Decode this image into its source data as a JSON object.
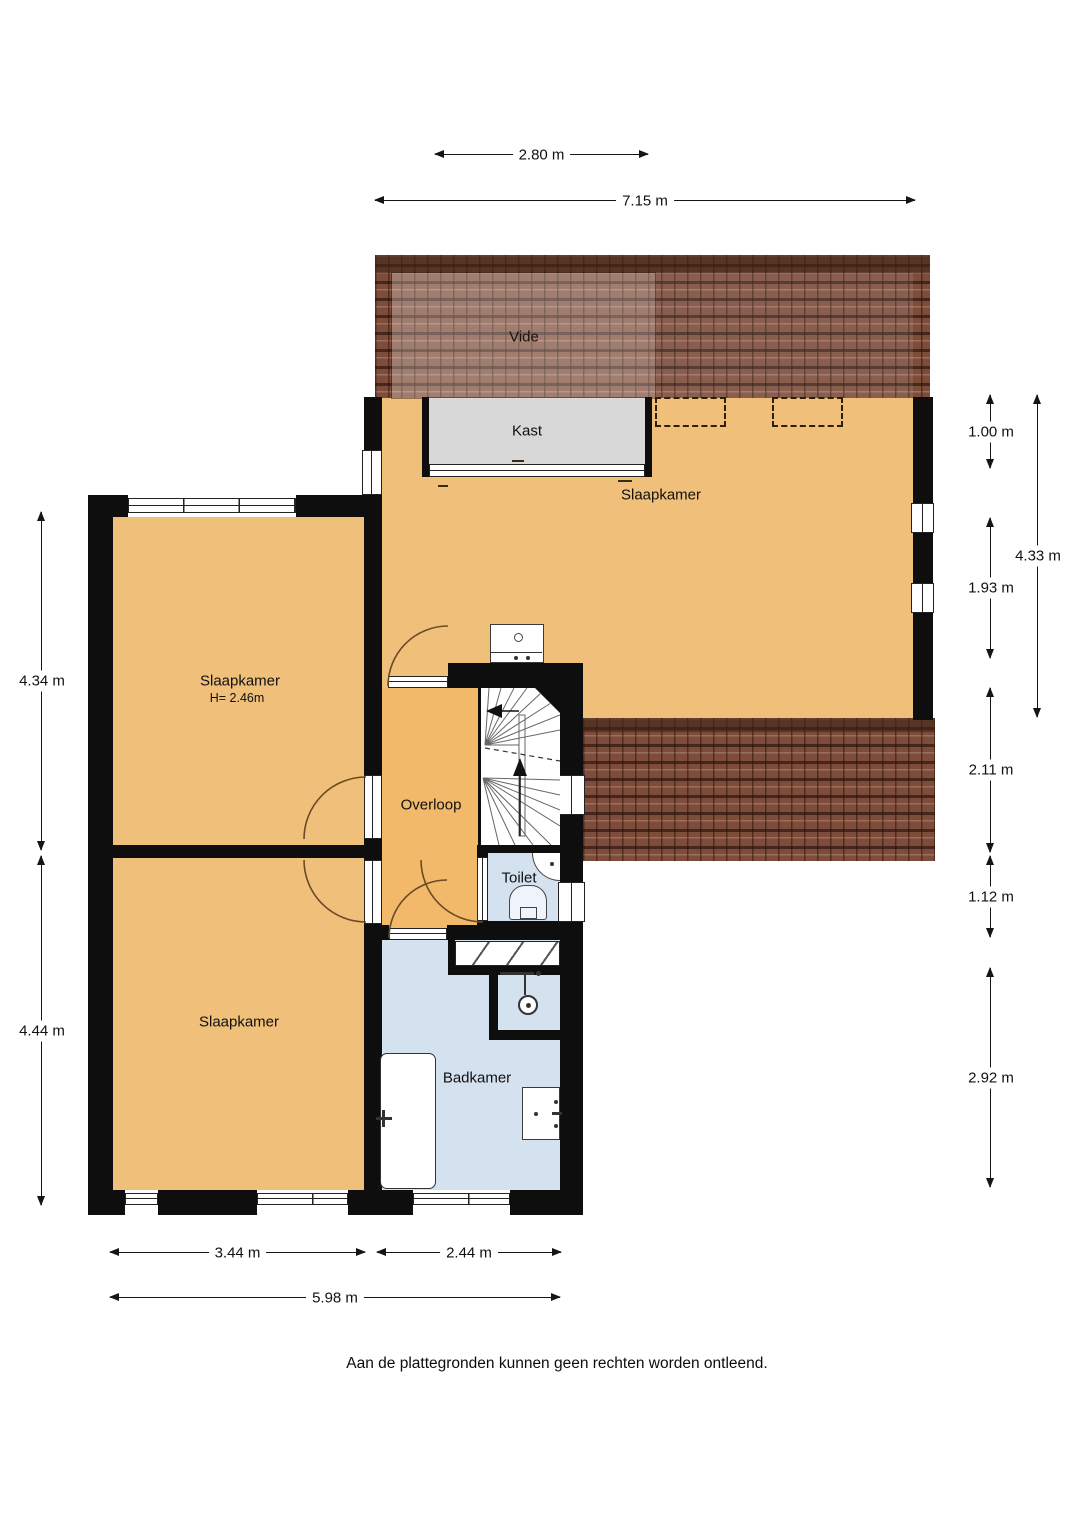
{
  "rooms": {
    "vide": {
      "label": "Vide"
    },
    "kast": {
      "label": "Kast"
    },
    "bedroom_main": {
      "label": "Slaapkamer"
    },
    "bedroom_left_top": {
      "label": "Slaapkamer",
      "ceiling_height": "H= 2.46m"
    },
    "bedroom_left_bottom": {
      "label": "Slaapkamer"
    },
    "landing": {
      "label": "Overloop"
    },
    "toilet": {
      "label": "Toilet"
    },
    "bathroom": {
      "label": "Badkamer"
    }
  },
  "dimensions": {
    "top_inner": "2.80 m",
    "top_total": "7.15 m",
    "right_top": "1.00 m",
    "right_mid": "1.93 m",
    "right_span": "4.33 m",
    "right_lower": "2.11 m",
    "right_small": "1.12 m",
    "right_bottom": "2.92 m",
    "left_top": "4.34 m",
    "left_bottom": "4.44 m",
    "bottom_left": "3.44 m",
    "bottom_right": "2.44 m",
    "bottom_total": "5.98 m"
  },
  "footer": {
    "disclaimer": "Aan de plattegronden kunnen geen rechten worden ontleend."
  },
  "fixtures": {
    "icons": [
      "washbasin-icon",
      "corner-sink-icon",
      "toilet-bowl-icon",
      "shower-head-icon",
      "bathtub-icon",
      "staircase-icon"
    ]
  },
  "colors": {
    "floor": "#f0c07a",
    "landing": "#f2b96b",
    "wet_room": "#d4e2ef",
    "closet": "#d8d8d8",
    "wall": "#0e0e0e",
    "roof_base": "#7d4c3a",
    "roof_shadow": "#3f2418",
    "door_arc": "#6b4a23",
    "outline": "#222222"
  }
}
